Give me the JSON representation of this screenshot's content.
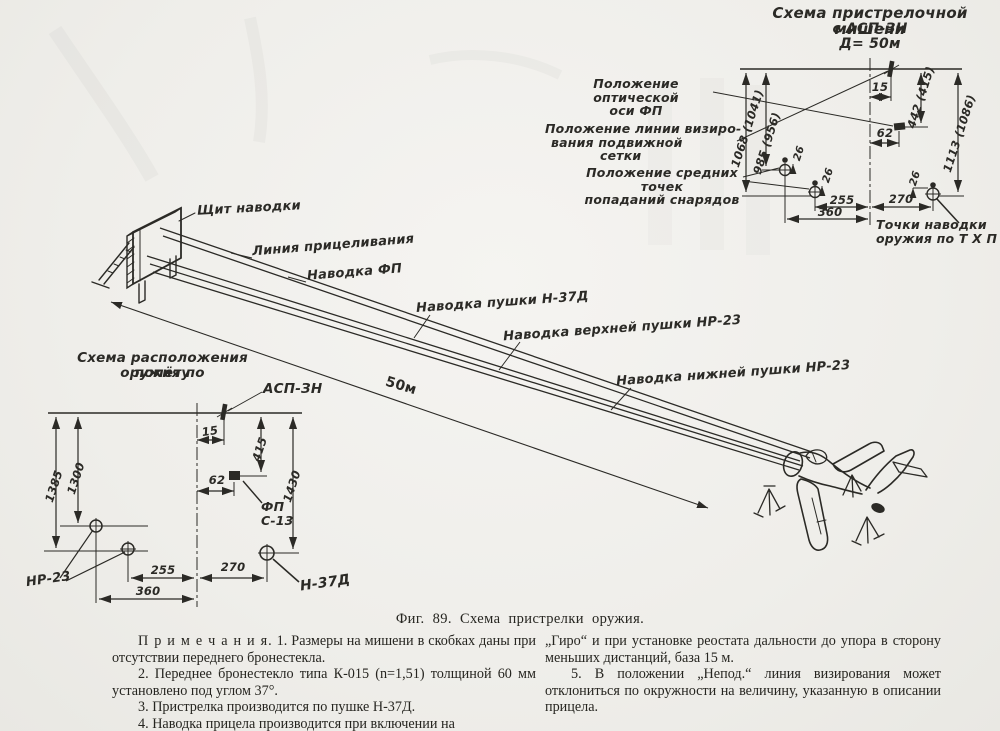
{
  "colors": {
    "paper": "#f0efeb",
    "ink": "#2b2a26"
  },
  "target_scheme": {
    "title": [
      "Схема пристрелочной мишени",
      "с АСП-ЗН",
      "Д= 50м"
    ],
    "labels": {
      "optical_axis": [
        "Положение оптической",
        "оси ФП"
      ],
      "sight_line": [
        "Положение линии визиро-",
        "вания подвижной",
        "сетки"
      ],
      "impact_points": [
        "Положение средних точек",
        "попаданий снарядов"
      ],
      "aiming_points": [
        "Точки наводки",
        "оружия по Т Х П"
      ]
    },
    "dims": {
      "d1068": "1068 (1041)",
      "d985": "985 (956)",
      "d442": "442 (415)",
      "d1113": "1113 (1086)",
      "d15": "15",
      "d62": "62",
      "d26a": "26",
      "d26b": "26",
      "d26c": "26",
      "d255": "255",
      "d270": "270",
      "d360": "360"
    }
  },
  "scene": {
    "board_label": "Щит наводки",
    "line_labels": {
      "aim_line": "Линия прицеливания",
      "fp": "Наводка ФП",
      "n37": "Наводка пушки Н-37Д",
      "nr23_top": "Наводка верхней пушки НР-23",
      "nr23_bottom": "Наводка нижней пушки НР-23"
    },
    "distance": "50м"
  },
  "layout_scheme": {
    "title": [
      "Схема расположения оружия по",
      "полёту"
    ],
    "labels": {
      "asp": "АСП-ЗН",
      "fp_line1": "ФП",
      "fp_line2": "С-13",
      "nr23": "НР-23",
      "n37": "Н-37Д"
    },
    "dims": {
      "d15": "15",
      "d415": "415",
      "d1430": "1430",
      "d62": "62",
      "d1385": "1385",
      "d1300": "1300",
      "d255": "255",
      "d270": "270",
      "d360": "360"
    }
  },
  "figure": {
    "caption": "Фиг. 89. Схема пристрелки оружия."
  },
  "notes": {
    "left": [
      {
        "lead": "П р и м е ч а н и я.",
        "body": " 1. Размеры на мишени в скобках даны при отсутствии переднего бронестекла."
      },
      {
        "lead": "",
        "body": "2. Переднее бронестекло типа К-015 (n=1,51) толщиной 60 мм установлено под углом 37°."
      },
      {
        "lead": "",
        "body": "3. Пристрелка производится по пушке Н-37Д."
      },
      {
        "lead": "",
        "body": "4. Наводка прицела производится при включении на"
      }
    ],
    "right": [
      {
        "lead": "",
        "body": "„Гиро“ и при установке реостата дальности до упора в сторону меньших дистанций, база 15 м."
      },
      {
        "lead": "",
        "body": "5. В положении „Непод.“ линия визирования может отклониться по окружности на величину, указанную в описании прицела."
      }
    ]
  }
}
